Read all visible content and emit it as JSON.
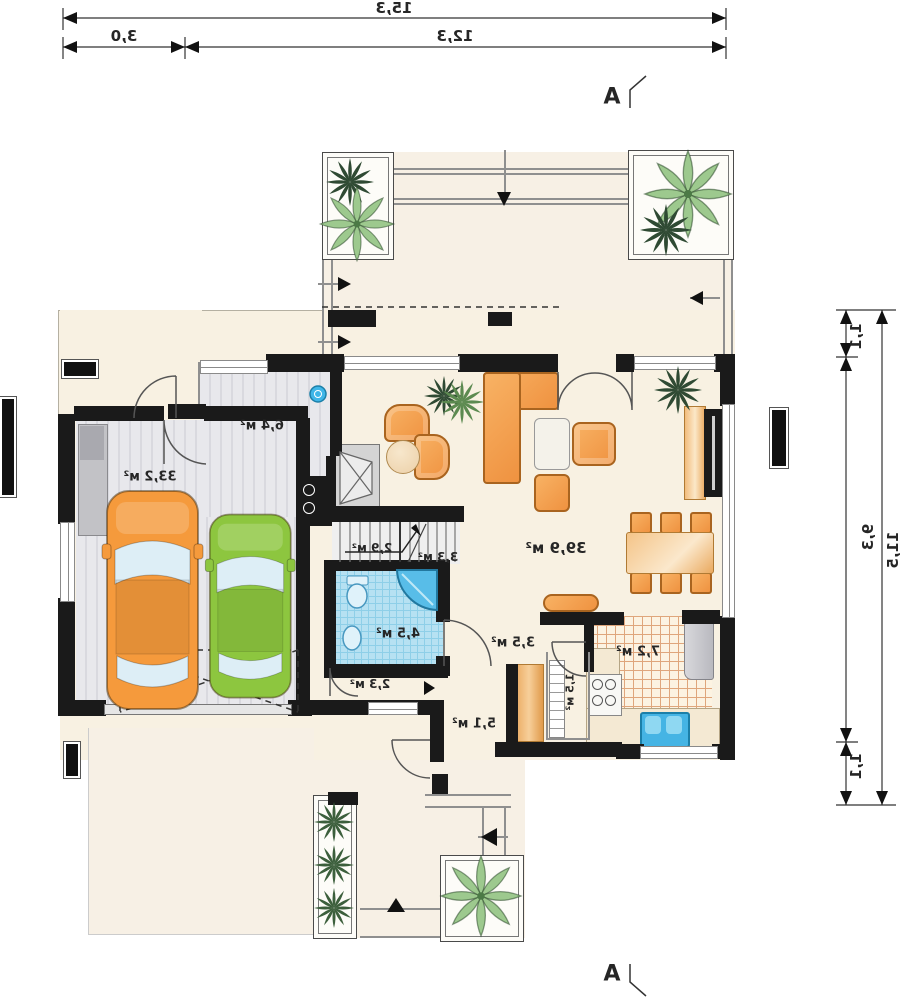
{
  "drawing": {
    "section_label": "A",
    "rooms": [
      {
        "id": "garage",
        "area": "33,2 м²"
      },
      {
        "id": "utility",
        "area": "6,4 м²"
      },
      {
        "id": "living-room",
        "area": "39,9 м²"
      },
      {
        "id": "stairs-lower",
        "area": "2,9 м²"
      },
      {
        "id": "stairs-upper",
        "area": "3,3 м²"
      },
      {
        "id": "bathroom",
        "area": "4,5 м²"
      },
      {
        "id": "closet",
        "area": "2,3 м²"
      },
      {
        "id": "hall",
        "area": "3,5 м²"
      },
      {
        "id": "entry-hall",
        "area": "5,1 м²"
      },
      {
        "id": "pantry",
        "area": "1,5 м²"
      },
      {
        "id": "kitchen",
        "area": "7,2 м²"
      }
    ],
    "dimensions_top": {
      "total": "15,3",
      "left": "3,0",
      "right": "12,3"
    },
    "dimensions_right": {
      "total": "11,5",
      "top": "1,1",
      "middle": "9,3",
      "bottom": "1,1"
    },
    "colors": {
      "wall": "#1a1a1a",
      "floor_cream": "#f8f1e2",
      "bath_blue": "#b6e1f2",
      "kitchen_tile_line": "#dfa67c",
      "furniture_orange": "#ef9240",
      "car_orange": "#f59a3c",
      "car_green": "#8dc63f",
      "plant_light": "#9dc98e",
      "plant_dark": "#3c5a3c",
      "fixture_blue": "#45b4e4"
    }
  }
}
